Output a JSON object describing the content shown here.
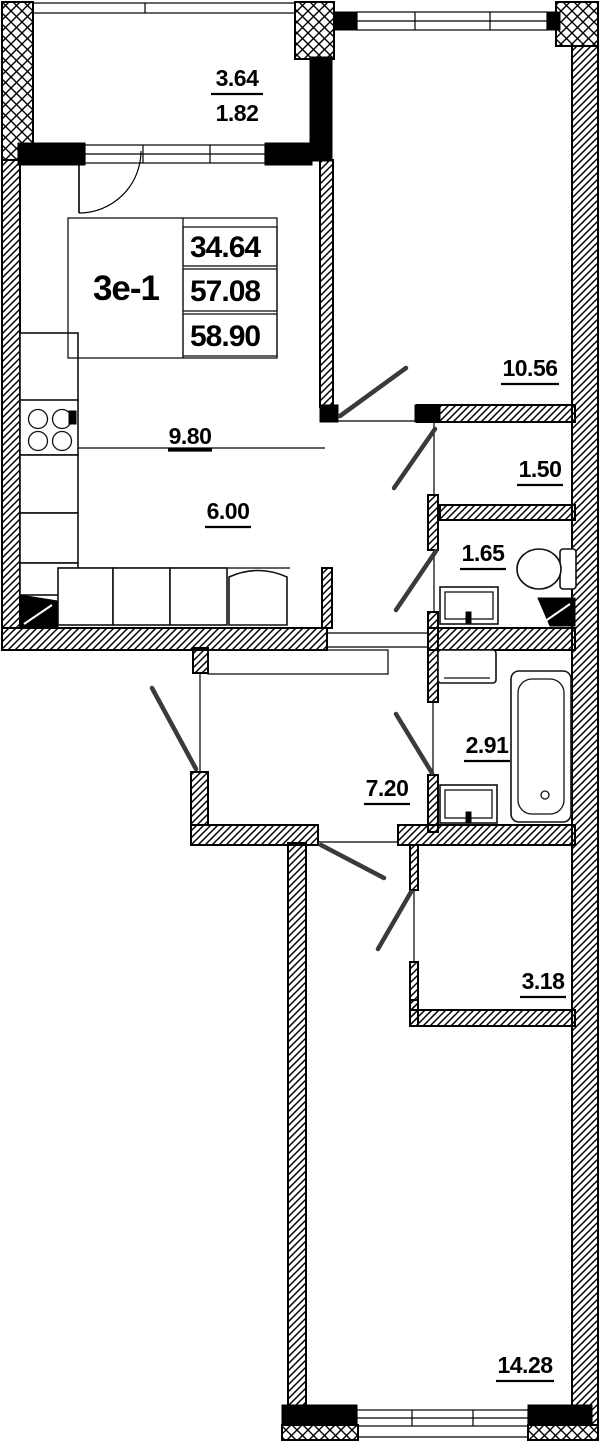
{
  "unit": {
    "code": "3е-1",
    "areas": {
      "living": "34.64",
      "total": "57.08",
      "total_with_balcony": "58.90"
    }
  },
  "room_areas": {
    "balcony_full": "3.64",
    "balcony_counted": "1.82",
    "bedroom_upper": "10.56",
    "wardrobe": "1.50",
    "wc": "1.65",
    "kitchen_zone": "9.80",
    "living_zone": "6.00",
    "bathroom": "2.91",
    "hallway": "7.20",
    "storage": "3.18",
    "bedroom_lower": "14.28"
  }
}
